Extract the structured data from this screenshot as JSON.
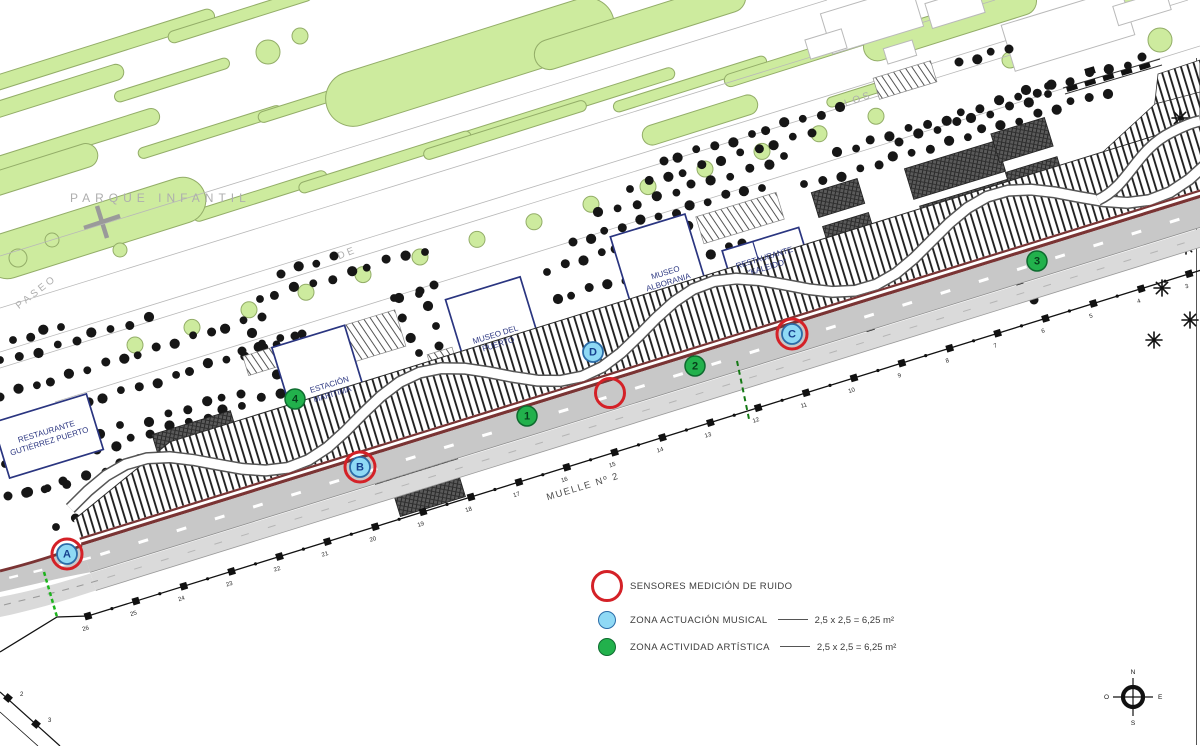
{
  "plan": {
    "street_labels": {
      "parque": "PARQUE INFANTIL",
      "paseo": "PASEO",
      "de": "DE",
      "los": "LOS"
    },
    "quay": {
      "label": "MUELLE Nº 2",
      "bollard_from": 3,
      "bollard_to": 26,
      "pier_numbers": [
        "2",
        "3"
      ]
    },
    "buildings": [
      {
        "id": "restaurante-gutierrez-puerto",
        "line1": "RESTAURANTE",
        "line2": "GUTIÉRREZ PUERTO"
      },
      {
        "id": "estacion-maritima",
        "line1": "ESTACIÓN",
        "line2": "MARÍTIMA"
      },
      {
        "id": "museo-del-puerto",
        "line1": "MUSEO DEL",
        "line2": "PUERTO"
      },
      {
        "id": "museo-alborania",
        "line1": "MUSEO",
        "line2": "ALBORANIA"
      },
      {
        "id": "restaurante-kaleido",
        "line1": "RESTAURANTE",
        "line2": "\"KALEIDO\""
      }
    ],
    "markers": {
      "musical": [
        {
          "id": "A",
          "ringed": true
        },
        {
          "id": "B",
          "ringed": true
        },
        {
          "id": "C",
          "ringed": true
        },
        {
          "id": "D",
          "ringed": false
        }
      ],
      "artistic": [
        {
          "id": "1"
        },
        {
          "id": "2"
        },
        {
          "id": "3"
        },
        {
          "id": "4"
        }
      ],
      "sensor_only_count": 1
    },
    "legend": {
      "items": [
        {
          "label": "SENSORES MEDICIÓN DE RUIDO",
          "dims": ""
        },
        {
          "label": "ZONA ACTUACIÓN MUSICAL",
          "dims": "2,5 x 2,5 = 6,25 m²"
        },
        {
          "label": "ZONA ACTIVIDAD ARTÍSTICA",
          "dims": "2,5 x 2,5 = 6,25 m²"
        }
      ]
    },
    "compass": {
      "n": "N",
      "s": "S",
      "e": "E",
      "o": "O"
    },
    "colors": {
      "sensor_red": "#d42127",
      "musical_blue": "#8fd9f5",
      "musical_blue_border": "#2b6ca8",
      "musical_text": "#17418f",
      "artistic_green": "#22b14c",
      "artistic_green_border": "#0e6b2f",
      "artistic_text": "#073f1b",
      "park_green": "#cdeb9e",
      "park_green_border": "#93ad68",
      "road_gray": "#c8c8c8",
      "lane_gray": "#dadada",
      "maroon": "#7a3434",
      "building_border": "#2a3580",
      "tree_black": "#161616",
      "label_gray": "#aeaeae",
      "dash_green_bright": "#1db31d",
      "dash_green_dark": "#157a15"
    }
  }
}
